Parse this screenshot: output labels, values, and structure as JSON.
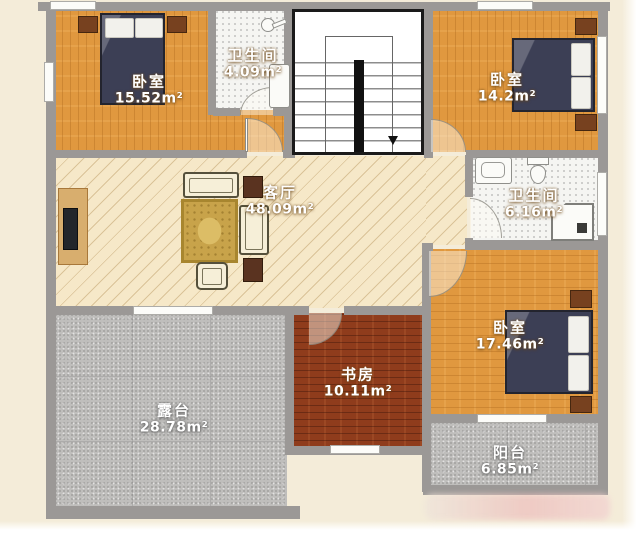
{
  "title": "floor-plan",
  "rooms": {
    "bedroom_tl": {
      "name": "卧室",
      "area": "15.52m²"
    },
    "bathroom_top": {
      "name": "卫生间",
      "area": "4.09m²"
    },
    "bedroom_tr": {
      "name": "卧室",
      "area": "14.2m²"
    },
    "living_room": {
      "name": "客厅",
      "area": "48.09m²"
    },
    "bathroom_right": {
      "name": "卫生间",
      "area": "6.16m²"
    },
    "bedroom_br": {
      "name": "卧室",
      "area": "17.46m²"
    },
    "study": {
      "name": "书房",
      "area": "10.11m²"
    },
    "terrace": {
      "name": "露台",
      "area": "28.78m²"
    },
    "balcony": {
      "name": "阳台",
      "area": "6.85m²"
    }
  },
  "colors": {
    "wood_orange": "#e0983f",
    "wood_rust": "#8f3c1c",
    "living_cream": "#f6e8c8",
    "tile_white": "#f5f5f2",
    "stone_gray": "#bfbebc",
    "wall_gray": "#9b9896",
    "bed_navy": "#3c3f55",
    "stair_frame_black": "#1a1a1a",
    "background_cream": "#f4ecd9"
  }
}
